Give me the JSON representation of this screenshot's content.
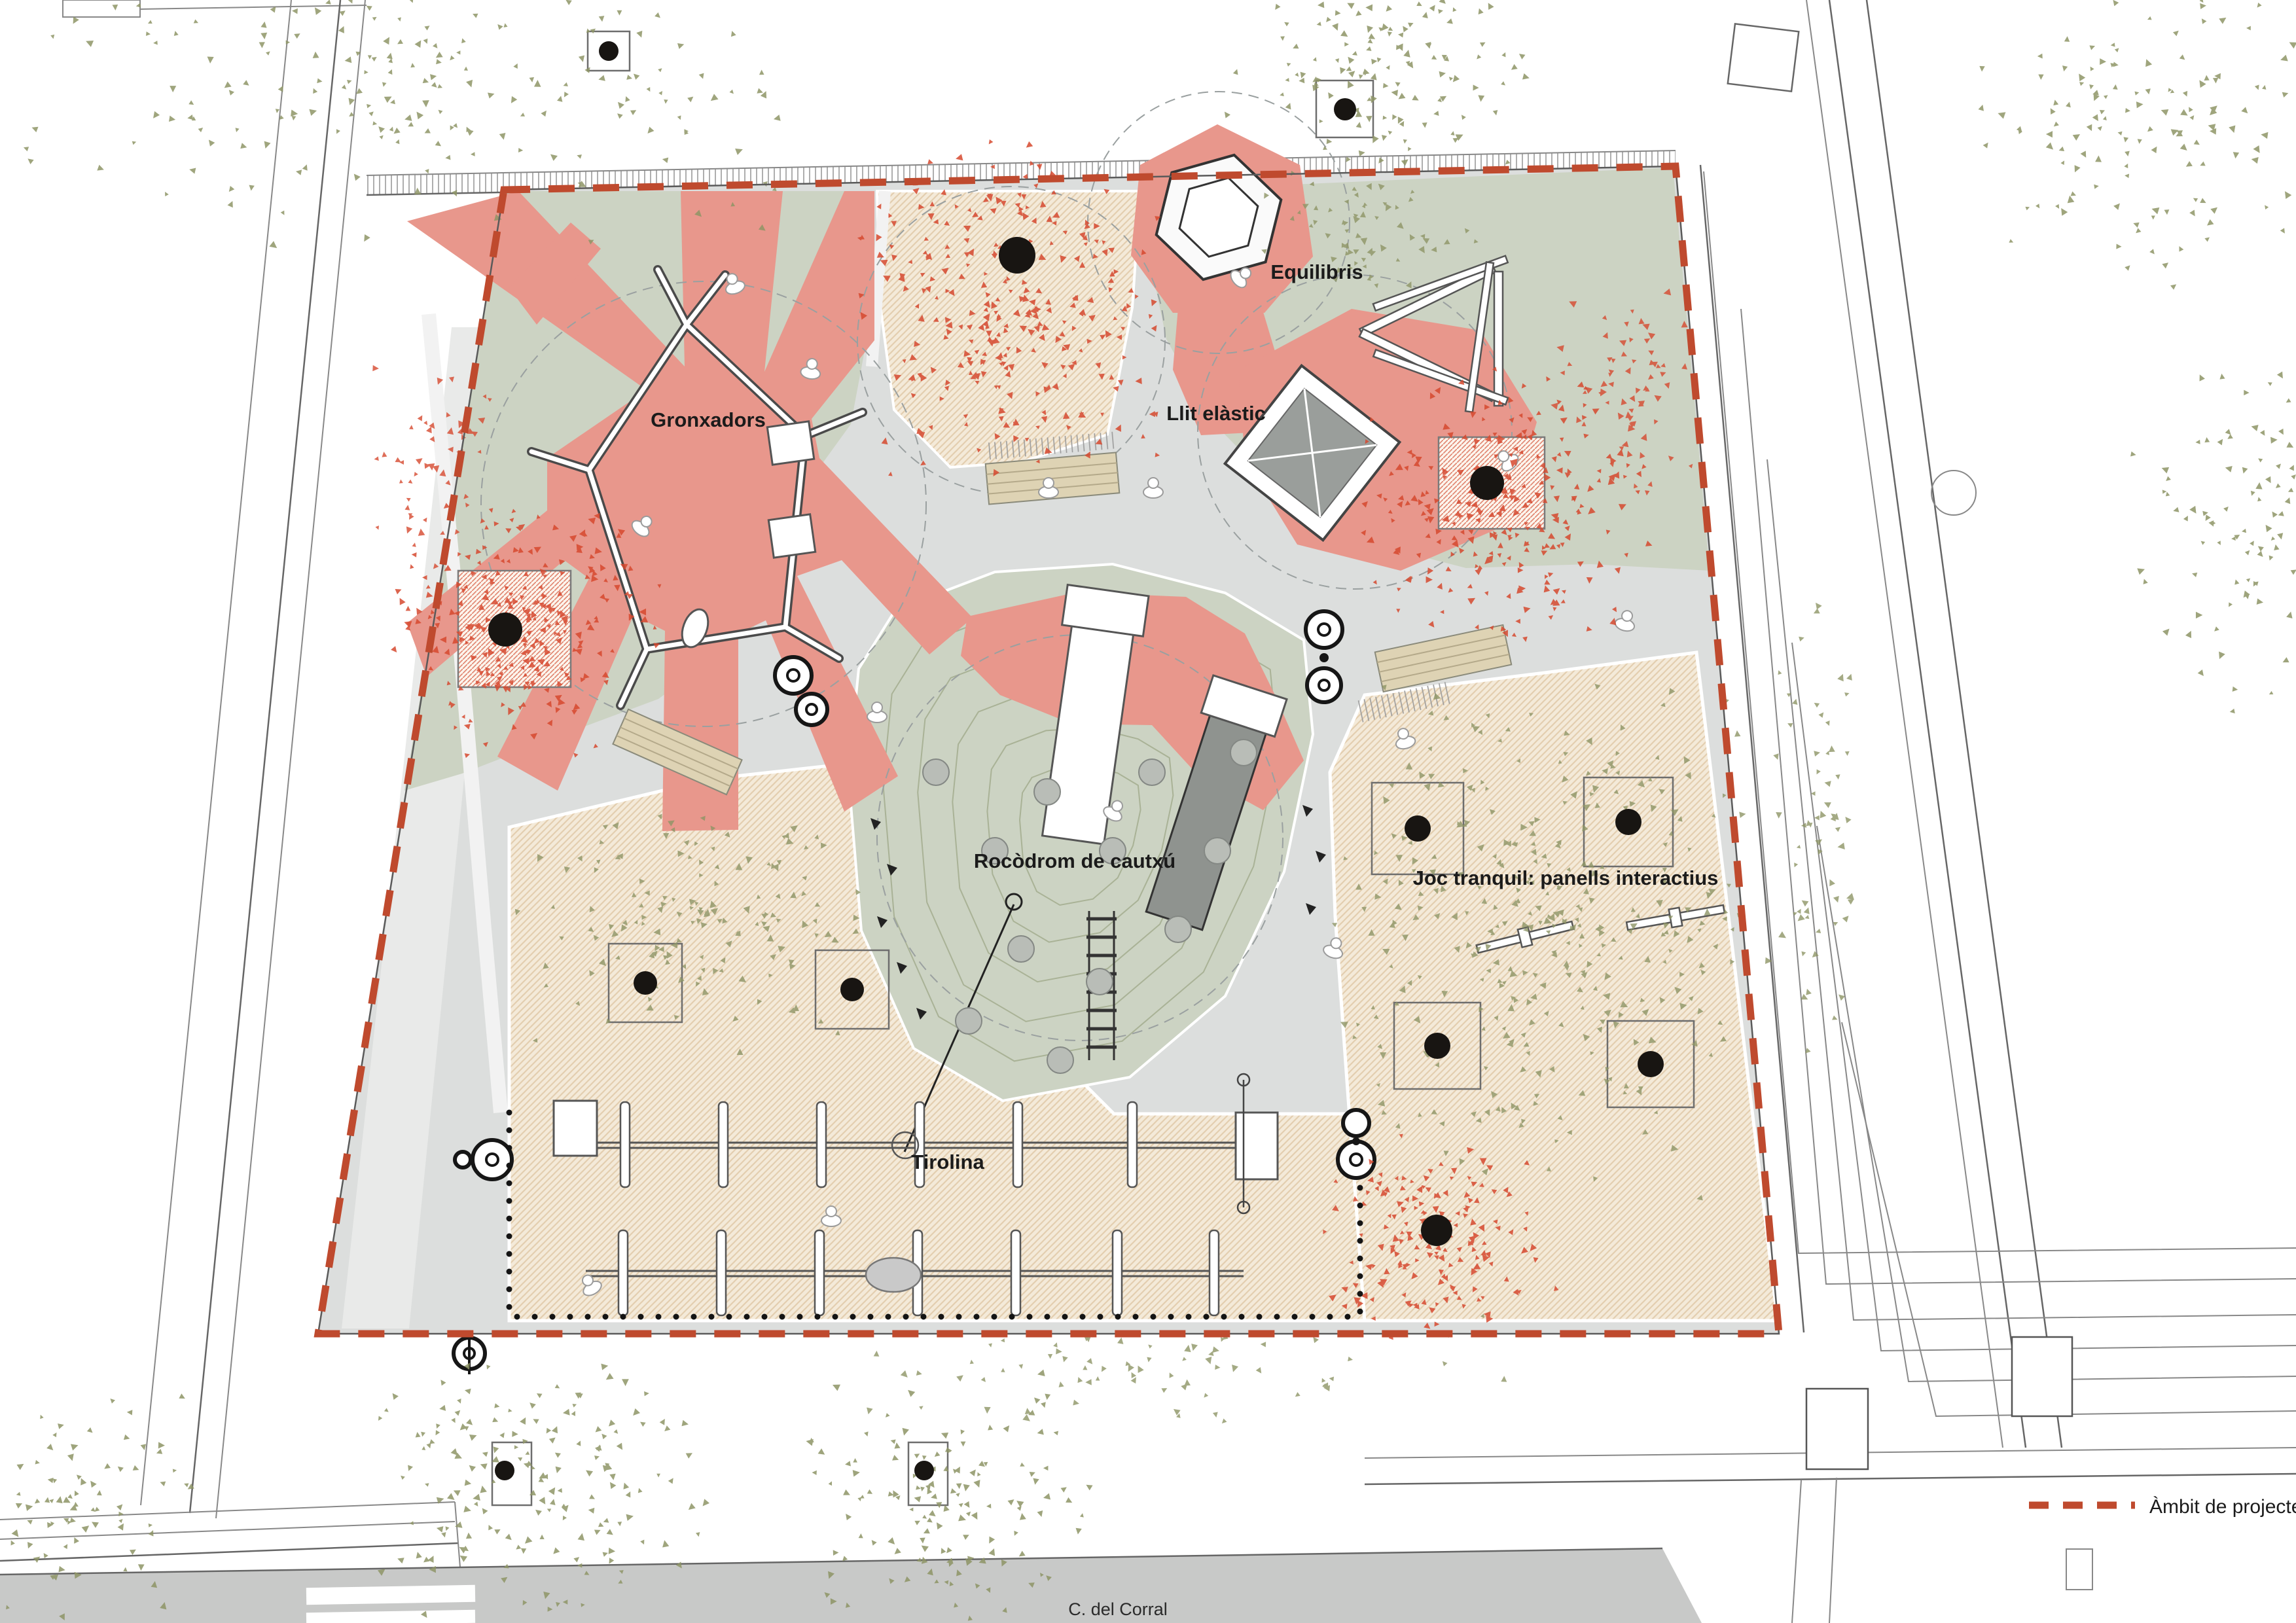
{
  "plan": {
    "title": "Playground site plan",
    "zones": [
      {
        "id": "gronxadors",
        "label": "Gronxadors"
      },
      {
        "id": "equilibris",
        "label": "Equilibris"
      },
      {
        "id": "llit-elastic",
        "label": "Llit elàstic"
      },
      {
        "id": "rocodrom",
        "label": "Rocòdrom de cautxú"
      },
      {
        "id": "joc-tranquil",
        "label": "Joc tranquil: panells interactius"
      },
      {
        "id": "tirolina",
        "label": "Tirolina"
      }
    ],
    "street_label": "C. del Corral",
    "legend": {
      "symbol": "red-dashed-line",
      "label": "Àmbit de projecte: 906 m²"
    },
    "colors": {
      "paper": "#ffffff",
      "path_gray": "#dcdedd",
      "corridor_light": "#e9eae9",
      "street_gray": "#c8c9c8",
      "green": "#ccd3c3",
      "beige": "#f4ead9",
      "beige_hatch": "#e3ceaf",
      "red": "#e8978c",
      "red_deep": "#bf4a2e",
      "foliage_green": "#8e9566",
      "foliage_red": "#d6492f",
      "contour": "#a9b296",
      "bench": "#ded3b4",
      "slide_gray": "#8f938f",
      "trampoline_gray": "#9a9e9b"
    }
  }
}
